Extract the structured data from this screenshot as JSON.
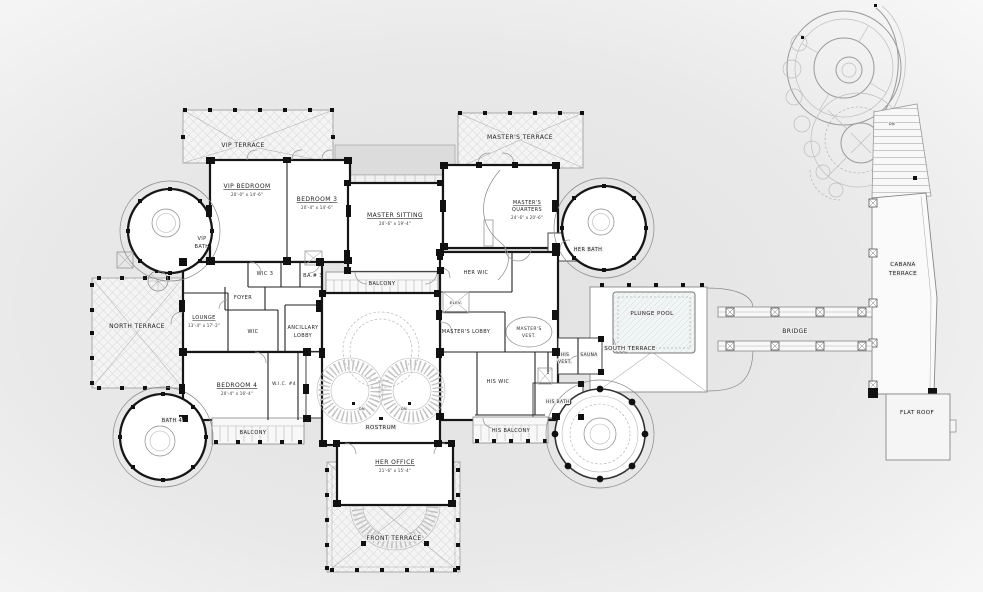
{
  "colors": {
    "background": "#e9e9e9",
    "paper": "#ffffff",
    "wall": "#161616",
    "hatch_line": "#dcdcdc",
    "label": "#222222"
  },
  "rooms": {
    "vip_terrace": {
      "name": "VIP TERRACE"
    },
    "vip_bedroom": {
      "name": "VIP BEDROOM",
      "dims": "20'-0\" x 14'-6\""
    },
    "bedroom_3": {
      "name": "BEDROOM 3",
      "dims": "20'-4\" x 14'-6\""
    },
    "vip_bath": {
      "line1": "VIP",
      "line2": "BATH"
    },
    "masters_terrace": {
      "name": "MASTER'S TERRACE"
    },
    "master_sitting": {
      "name": "MASTER SITTING",
      "dims": "20'-6\" x 19'-4\""
    },
    "masters_quarters": {
      "line1": "MASTER'S",
      "line2": "QUARTERS",
      "dims": "24'-6\" x 20'-6\""
    },
    "her_bath": {
      "name": "HER BATH"
    },
    "her_wic": {
      "name": "HER WIC"
    },
    "elevator": {
      "name": "ELEV."
    },
    "masters_lobby": {
      "name": "MASTER'S LOBBY"
    },
    "masters_vest": {
      "line1": "MASTER'S",
      "line2": "VEST."
    },
    "north_terrace": {
      "name": "NORTH TERRACE"
    },
    "lounge": {
      "name": "LOUNGE",
      "dims": "13'-4\" x 17'-2\""
    },
    "foyer": {
      "name": "FOYER"
    },
    "wic": {
      "name": "WIC"
    },
    "wic_3": {
      "name": "WIC 3"
    },
    "ba_3": {
      "name": "BA.# 3"
    },
    "ancillary_lobby": {
      "line1": "ANCILLARY",
      "line2": "LOBBY"
    },
    "balcony_top": {
      "name": "BALCONY"
    },
    "rostrum": {
      "name": "ROSTRUM"
    },
    "bedroom_4": {
      "name": "BEDROOM 4",
      "dims": "20'-4\" x 16'-4\""
    },
    "wic_4": {
      "name": "W.I.C. #4"
    },
    "balcony_bottom": {
      "name": "BALCONY"
    },
    "bath_4": {
      "name": "BATH 4"
    },
    "her_office": {
      "name": "HER OFFICE",
      "dims": "21'-6\" x 15'-4\""
    },
    "front_terrace": {
      "name": "FRONT TERRACE"
    },
    "his_wic": {
      "name": "HIS WIC"
    },
    "his_vest": {
      "line1": "HIS",
      "line2": "VEST."
    },
    "sauna": {
      "name": "SAUNA"
    },
    "his_bath": {
      "name": "HIS BATH"
    },
    "his_balcony": {
      "name": "HIS BALCONY"
    },
    "south_terrace": {
      "name": "SOUTH TERRACE"
    },
    "plunge_pool": {
      "name": "PLUNGE POOL"
    }
  },
  "site": {
    "bridge": {
      "name": "BRIDGE"
    },
    "cabana_terrace": {
      "line1": "CABANA",
      "line2": "TERRACE"
    },
    "flat_roof": {
      "name": "FLAT ROOF"
    }
  },
  "annotations": {
    "dn": "DN"
  }
}
